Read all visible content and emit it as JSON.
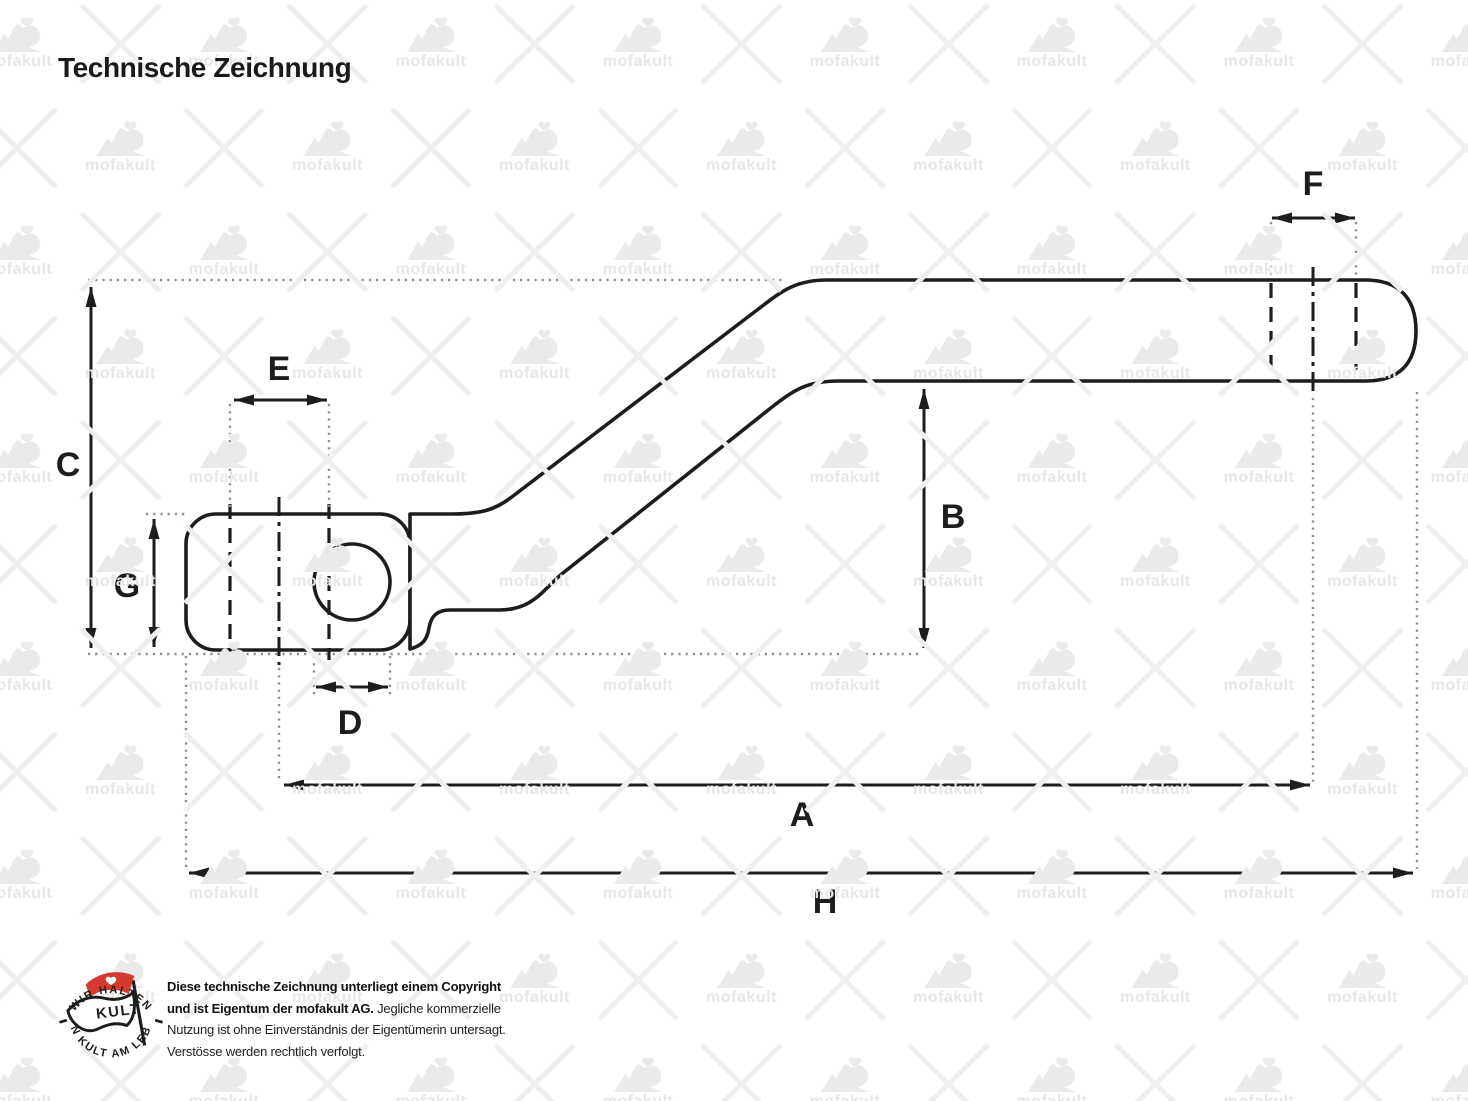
{
  "title": "Technische Zeichnung",
  "watermark": {
    "text": "mofakult",
    "color": "#eaeaea"
  },
  "drawing": {
    "description": "kickstart-pedal-lever-side-view",
    "dimensions": [
      {
        "id": "A",
        "label": "A"
      },
      {
        "id": "B",
        "label": "B"
      },
      {
        "id": "C",
        "label": "C"
      },
      {
        "id": "D",
        "label": "D"
      },
      {
        "id": "E",
        "label": "E"
      },
      {
        "id": "F",
        "label": "F"
      },
      {
        "id": "G",
        "label": "G"
      },
      {
        "id": "H",
        "label": "H"
      }
    ]
  },
  "footer": {
    "badge": {
      "arc_top": "WIR HALTEN",
      "arc_bottom": "DEN KULT AM LEBEN",
      "flag": "KULT",
      "flag_color": "#d5392f"
    },
    "copyright_lines": [
      {
        "bold": "Diese technische Zeichnung unterliegt einem Copyright",
        "regular": ""
      },
      {
        "bold": "und ist Eigentum der mofakult AG.",
        "regular": " Jegliche kommerzielle"
      },
      {
        "bold": "",
        "regular": "Nutzung ist ohne Einverständnis der Eigentümerin untersagt."
      },
      {
        "bold": "",
        "regular": "Verstösse werden rechtlich verfolgt."
      }
    ]
  },
  "colors": {
    "ink": "#1d1d1b",
    "dotted_gray": "#8f8f8f",
    "watermark_gray": "#eaeaea",
    "badge_red": "#d5392f",
    "background": "#ffffff"
  }
}
